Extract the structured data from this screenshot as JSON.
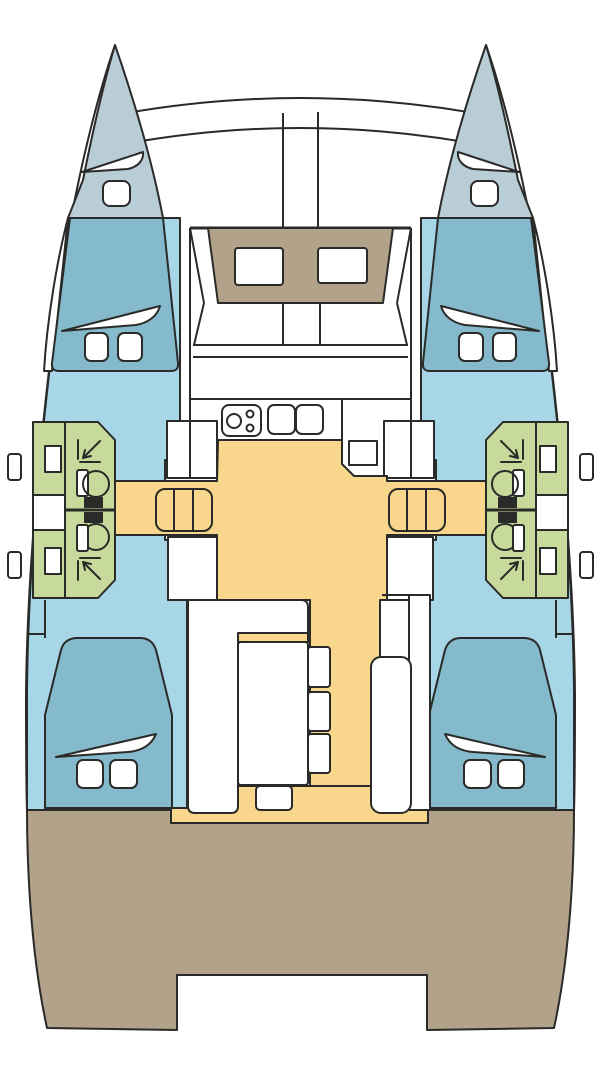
{
  "diagram": {
    "kind": "catamaran-deck-plan",
    "description": "Top-down floor plan of a sailing catamaran: two hulls with forward cabins, bathrooms and aft cabins, central salon with galley and dinette, cockpit and aft deck"
  },
  "colors": {
    "outline": "#2a2a28",
    "white": "#ffffff",
    "bow_deck": "#b8cdd6",
    "cabin_blue": "#a7d6e7",
    "bed_blue": "#84bacb",
    "bath_green": "#c7da9c",
    "floor_yellow": "#f8d68b",
    "deck_tan": "#b2a289"
  },
  "regions": [
    {
      "name": "bow-locker",
      "color": "bow_deck"
    },
    {
      "name": "forward-cabin-berth",
      "color": "bed_blue"
    },
    {
      "name": "hull-interior",
      "color": "cabin_blue"
    },
    {
      "name": "bathroom",
      "color": "bath_green"
    },
    {
      "name": "salon-floor-and-corridor",
      "color": "floor_yellow"
    },
    {
      "name": "companionway-steps",
      "color": "floor_yellow"
    },
    {
      "name": "aft-cabin-berth",
      "color": "bed_blue"
    },
    {
      "name": "cockpit-floor",
      "color": "floor_yellow"
    },
    {
      "name": "aft-deck",
      "color": "deck_tan"
    },
    {
      "name": "coachroof-front",
      "color": "deck_tan"
    }
  ]
}
